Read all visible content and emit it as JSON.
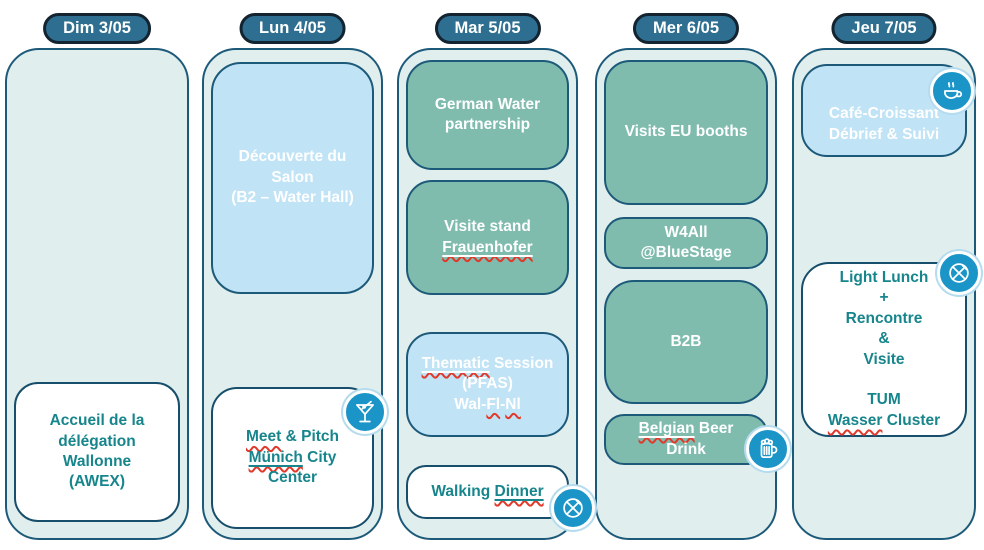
{
  "colors": {
    "pill_bg": "#2e6f91",
    "pill_border": "#13232f",
    "container_bg": "#e0efed",
    "container_border": "#1d5a7a",
    "card_teal": "#7fbcae",
    "card_blue": "#c0e3f6",
    "card_white": "#ffffff",
    "teal_text": "#17858c",
    "icon_circle_bg": "#1b95c7",
    "squiggle_red": "#e0392b"
  },
  "columns": [
    {
      "header": "Dim 3/05",
      "cards": [
        {
          "style": "white",
          "lines": [
            [
              {
                "t": "Accueil de la"
              }
            ],
            [
              {
                "t": "délégation"
              }
            ],
            [
              {
                "t": "Wallonne"
              }
            ],
            [
              {
                "t": "(AWEX)"
              }
            ]
          ]
        }
      ]
    },
    {
      "header": "Lun 4/05",
      "cards": [
        {
          "style": "blue",
          "lines": [
            [
              {
                "t": "Découverte du"
              }
            ],
            [
              {
                "t": "Salon"
              }
            ],
            [
              {
                "t": "(B2 – Water Hall)"
              }
            ]
          ]
        },
        {
          "style": "white",
          "icon": "martini-glass",
          "lines": [
            [
              {
                "t": "Meet",
                "d": "wavy"
              },
              {
                "t": " & Pitch"
              }
            ],
            [
              {
                "t": "Münich",
                "d": "solid-wavy"
              },
              {
                "t": " City"
              }
            ],
            [
              {
                "t": "Center"
              }
            ]
          ]
        }
      ]
    },
    {
      "header": "Mar 5/05",
      "cards": [
        {
          "style": "teal",
          "lines": [
            [
              {
                "t": "German Water"
              }
            ],
            [
              {
                "t": "partnership"
              }
            ]
          ]
        },
        {
          "style": "teal",
          "lines": [
            [
              {
                "t": "Visite stand"
              }
            ],
            [
              {
                "t": "Frauenhofer",
                "d": "solid-wavy"
              }
            ]
          ]
        },
        {
          "style": "blue",
          "lines": [
            [
              {
                "t": "Thematic",
                "d": "solid-wavy"
              },
              {
                "t": " Session"
              }
            ],
            [
              {
                "t": "(PFAS)"
              }
            ],
            [
              {
                "t": "Wal-"
              },
              {
                "t": "Fl",
                "d": "wavy"
              },
              {
                "t": "-"
              },
              {
                "t": "Nl",
                "d": "wavy"
              }
            ]
          ]
        },
        {
          "style": "white",
          "icon": "crossed-cutlery",
          "lines": [
            [
              {
                "t": "Walking "
              },
              {
                "t": "Dinner",
                "d": "solid-wavy"
              }
            ]
          ]
        }
      ]
    },
    {
      "header": "Mer 6/05",
      "cards": [
        {
          "style": "teal",
          "lines": [
            [
              {
                "t": "Visits EU booths"
              }
            ]
          ]
        },
        {
          "style": "teal",
          "lines": [
            [
              {
                "t": "W4All"
              }
            ],
            [
              {
                "t": "@BlueStage"
              }
            ]
          ]
        },
        {
          "style": "teal",
          "lines": [
            [
              {
                "t": "B2B"
              }
            ]
          ]
        },
        {
          "style": "teal",
          "icon": "beer-mug",
          "lines": [
            [
              {
                "t": "Belgian",
                "d": "solid-wavy"
              },
              {
                "t": " Beer"
              }
            ],
            [
              {
                "t": "Drink"
              }
            ]
          ]
        }
      ]
    },
    {
      "header": "Jeu 7/05",
      "cards": [
        {
          "style": "blue",
          "icon": "coffee-cup",
          "lines": [
            [
              {
                "t": "Café-Croissant"
              }
            ],
            [
              {
                "t": "Débrief & Suivi"
              }
            ]
          ]
        },
        {
          "style": "white",
          "icon": "crossed-cutlery",
          "lines": [
            [
              {
                "t": "Light Lunch"
              }
            ],
            [
              {
                "t": "+"
              }
            ],
            [
              {
                "t": "Rencontre"
              }
            ],
            [
              {
                "t": "&"
              }
            ],
            [
              {
                "t": "Visite"
              }
            ],
            [
              {
                "t": ""
              }
            ],
            [
              {
                "t": "TUM",
                "d": "strong"
              }
            ],
            [
              {
                "t": "Wasser",
                "d": "wavy"
              },
              {
                "t": " Cluster"
              }
            ]
          ]
        }
      ]
    }
  ]
}
